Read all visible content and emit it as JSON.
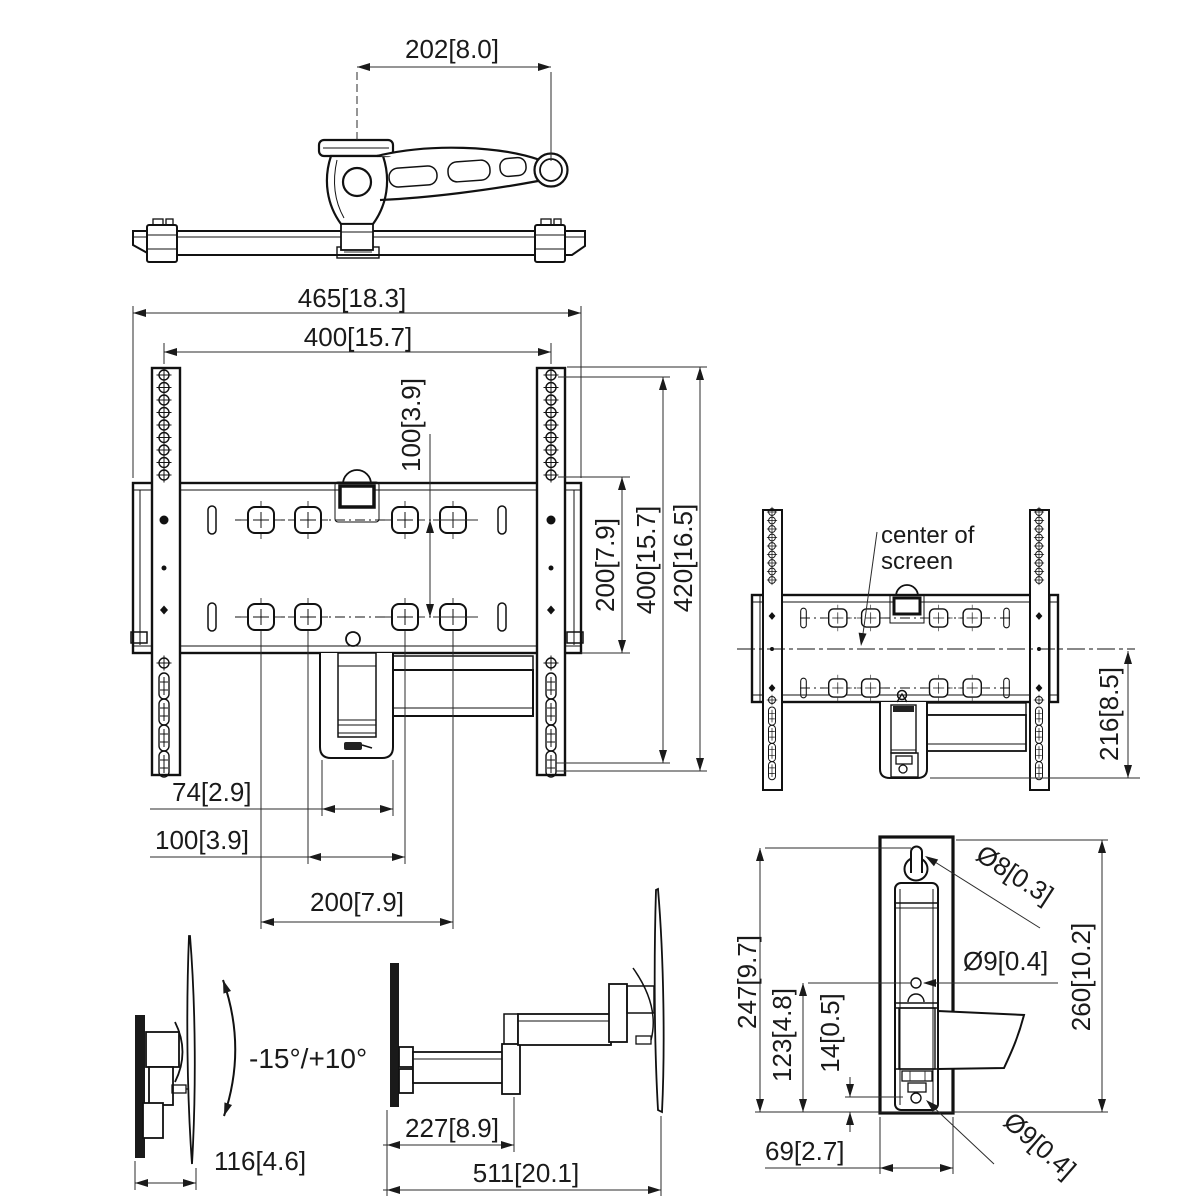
{
  "views": {
    "top": {
      "dim_span": "202[8.0]"
    },
    "front": {
      "dim_width_overall": "465[18.3]",
      "dim_width_vesa": "400[15.7]",
      "dim_pitch_100": "100[3.9]",
      "dim_height_200": "200[7.9]",
      "dim_height_400": "400[15.7]",
      "dim_height_overall": "420[16.5]",
      "dim_offset_74": "74[2.9]",
      "dim_offset_100": "100[3.9]",
      "dim_offset_200": "200[7.9]"
    },
    "side_folded": {
      "center_of_screen_line1": "center of",
      "center_of_screen_line2": "screen",
      "dim_center_to_bottom": "216[8.5]"
    },
    "tilt": {
      "tilt_range": "-15°/+10°",
      "dim_depth": "116[4.6]"
    },
    "extended": {
      "dim_first_arm": "227[8.9]",
      "dim_max_reach": "511[20.1]"
    },
    "wall_plate": {
      "dim_height_247": "247[9.7]",
      "dim_height_123": "123[4.8]",
      "dim_offset_14": "14[0.5]",
      "dim_height_260": "260[10.2]",
      "dim_width_69": "69[2.7]",
      "dia_top_hole": "Ø8[0.3]",
      "dia_mid_hole": "Ø9[0.4]",
      "dia_bottom_hole": "Ø9[0.4]"
    }
  },
  "colors": {
    "line": "#1a1a1a",
    "background": "#ffffff"
  }
}
